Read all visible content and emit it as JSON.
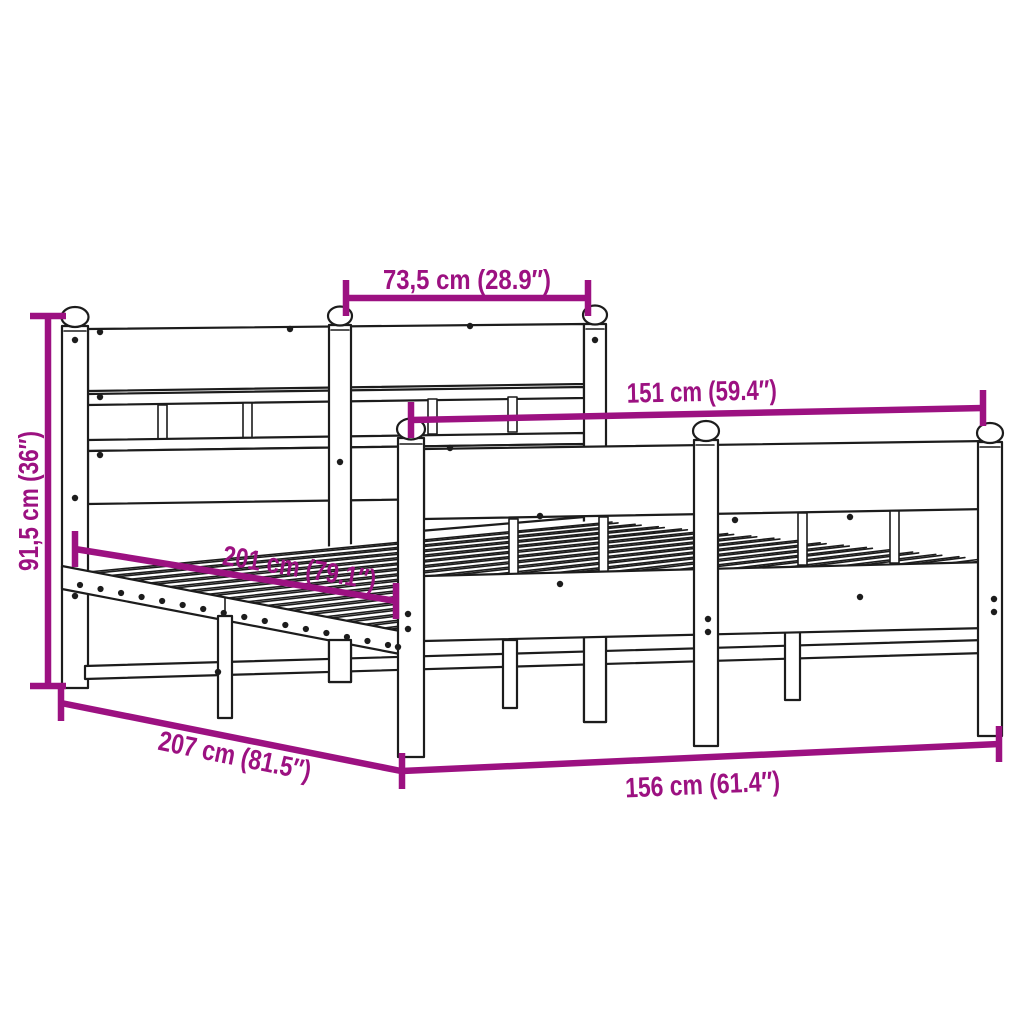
{
  "diagram": {
    "type": "product-dimension-diagram",
    "dimensions": [
      {
        "id": "headboard-section-width",
        "label": "73,5 cm (28.9″)"
      },
      {
        "id": "inner-width",
        "label": "151 cm (59.4″)"
      },
      {
        "id": "headboard-height",
        "label": "91,5 cm (36″)"
      },
      {
        "id": "slat-base-length",
        "label": "201 cm (79.1″)"
      },
      {
        "id": "total-length",
        "label": "207 cm (81.5″)"
      },
      {
        "id": "total-width",
        "label": "156 cm (61.4″)"
      }
    ]
  },
  "colors": {
    "accent": "#9c1181",
    "ink": "#1c1c1c",
    "bg": "#ffffff"
  }
}
